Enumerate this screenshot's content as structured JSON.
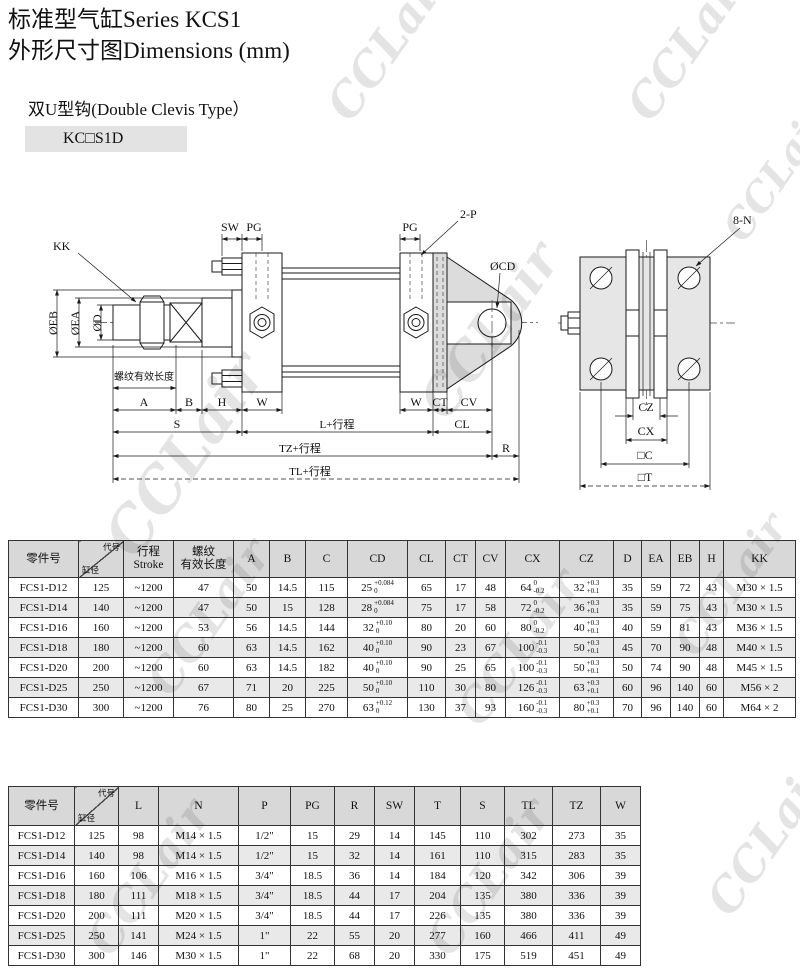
{
  "page": {
    "title_line1": "标准型气缸Series KCS1",
    "title_line2": "外形尺寸图Dimensions (mm)",
    "subtitle": "双U型钩(Double Clevis Type）",
    "model_badge": "KC□S1D",
    "watermark": "CCLair"
  },
  "drawing": {
    "labels": {
      "kk": "KK",
      "eb": "ØEB",
      "ea": "ØEA",
      "d": "ØD",
      "thread": "螺纹有效长度",
      "sw": "SW",
      "pg": "PG",
      "pg2": "PG",
      "two_p": "2-P",
      "cd": "ØCD",
      "a": "A",
      "b": "B",
      "h": "H",
      "w1": "W",
      "w2": "W",
      "ct": "CT",
      "cv": "CV",
      "s": "S",
      "l": "L+行程",
      "cl": "CL",
      "tz": "TZ+行程",
      "r": "R",
      "tl": "TL+行程",
      "n8": "8-N",
      "cz": "CZ",
      "cx": "CX",
      "c": "□C",
      "t": "□T"
    }
  },
  "table1": {
    "headers": [
      {
        "type": "plain",
        "text": "零件号"
      },
      {
        "type": "diag",
        "top": "代号",
        "bottom": "缸径"
      },
      {
        "type": "lines",
        "lines": [
          "行程",
          "Stroke"
        ]
      },
      {
        "type": "lines",
        "lines": [
          "螺纹",
          "有效长度"
        ]
      },
      {
        "type": "plain",
        "text": "A"
      },
      {
        "type": "plain",
        "text": "B"
      },
      {
        "type": "plain",
        "text": "C"
      },
      {
        "type": "plain",
        "text": "CD"
      },
      {
        "type": "plain",
        "text": "CL"
      },
      {
        "type": "plain",
        "text": "CT"
      },
      {
        "type": "plain",
        "text": "CV"
      },
      {
        "type": "plain",
        "text": "CX"
      },
      {
        "type": "plain",
        "text": "CZ"
      },
      {
        "type": "plain",
        "text": "D"
      },
      {
        "type": "plain",
        "text": "EA"
      },
      {
        "type": "plain",
        "text": "EB"
      },
      {
        "type": "plain",
        "text": "H"
      },
      {
        "type": "plain",
        "text": "KK"
      }
    ],
    "rows": [
      [
        "FCS1-D12",
        "125",
        "~1200",
        "47",
        "50",
        "14.5",
        "115",
        {
          "v": "25",
          "t": "+0.084",
          "b": "0"
        },
        "65",
        "17",
        "48",
        {
          "v": "64",
          "t": "0",
          "b": "-0.2"
        },
        {
          "v": "32",
          "t": "+0.3",
          "b": "+0.1"
        },
        "35",
        "59",
        "72",
        "43",
        "M30 × 1.5"
      ],
      [
        "FCS1-D14",
        "140",
        "~1200",
        "47",
        "50",
        "15",
        "128",
        {
          "v": "28",
          "t": "+0.084",
          "b": "0"
        },
        "75",
        "17",
        "58",
        {
          "v": "72",
          "t": "0",
          "b": "-0.2"
        },
        {
          "v": "36",
          "t": "+0.3",
          "b": "+0.1"
        },
        "35",
        "59",
        "75",
        "43",
        "M30 × 1.5"
      ],
      [
        "FCS1-D16",
        "160",
        "~1200",
        "53",
        "56",
        "14.5",
        "144",
        {
          "v": "32",
          "t": "+0.10",
          "b": "0"
        },
        "80",
        "20",
        "60",
        {
          "v": "80",
          "t": "0",
          "b": "-0.2"
        },
        {
          "v": "40",
          "t": "+0.3",
          "b": "+0.1"
        },
        "40",
        "59",
        "81",
        "43",
        "M36 × 1.5"
      ],
      [
        "FCS1-D18",
        "180",
        "~1200",
        "60",
        "63",
        "14.5",
        "162",
        {
          "v": "40",
          "t": "+0.10",
          "b": "0"
        },
        "90",
        "23",
        "67",
        {
          "v": "100",
          "t": "-0.1",
          "b": "-0.3"
        },
        {
          "v": "50",
          "t": "+0.3",
          "b": "+0.1"
        },
        "45",
        "70",
        "90",
        "48",
        "M40 × 1.5"
      ],
      [
        "FCS1-D20",
        "200",
        "~1200",
        "60",
        "63",
        "14.5",
        "182",
        {
          "v": "40",
          "t": "+0.10",
          "b": "0"
        },
        "90",
        "25",
        "65",
        {
          "v": "100",
          "t": "-0.1",
          "b": "-0.3"
        },
        {
          "v": "50",
          "t": "+0.3",
          "b": "+0.1"
        },
        "50",
        "74",
        "90",
        "48",
        "M45 × 1.5"
      ],
      [
        "FCS1-D25",
        "250",
        "~1200",
        "67",
        "71",
        "20",
        "225",
        {
          "v": "50",
          "t": "+0.10",
          "b": "0"
        },
        "110",
        "30",
        "80",
        {
          "v": "126",
          "t": "-0.1",
          "b": "-0.3"
        },
        {
          "v": "63",
          "t": "+0.3",
          "b": "+0.1"
        },
        "60",
        "96",
        "140",
        "60",
        "M56 × 2"
      ],
      [
        "FCS1-D30",
        "300",
        "~1200",
        "76",
        "80",
        "25",
        "270",
        {
          "v": "63",
          "t": "+0.12",
          "b": "0"
        },
        "130",
        "37",
        "93",
        {
          "v": "160",
          "t": "-0.1",
          "b": "-0.3"
        },
        {
          "v": "80",
          "t": "+0.3",
          "b": "+0.1"
        },
        "70",
        "96",
        "140",
        "60",
        "M64 × 2"
      ]
    ]
  },
  "table2": {
    "headers": [
      {
        "type": "plain",
        "text": "零件号"
      },
      {
        "type": "diag",
        "top": "代号",
        "bottom": "缸径"
      },
      {
        "type": "plain",
        "text": "L"
      },
      {
        "type": "plain",
        "text": "N"
      },
      {
        "type": "plain",
        "text": "P"
      },
      {
        "type": "plain",
        "text": "PG"
      },
      {
        "type": "plain",
        "text": "R"
      },
      {
        "type": "plain",
        "text": "SW"
      },
      {
        "type": "plain",
        "text": "T"
      },
      {
        "type": "plain",
        "text": "S"
      },
      {
        "type": "plain",
        "text": "TL"
      },
      {
        "type": "plain",
        "text": "TZ"
      },
      {
        "type": "plain",
        "text": "W"
      }
    ],
    "rows": [
      [
        "FCS1-D12",
        "125",
        "98",
        "M14 × 1.5",
        "1/2\"",
        "15",
        "29",
        "14",
        "145",
        "110",
        "302",
        "273",
        "35"
      ],
      [
        "FCS1-D14",
        "140",
        "98",
        "M14 × 1.5",
        "1/2\"",
        "15",
        "32",
        "14",
        "161",
        "110",
        "315",
        "283",
        "35"
      ],
      [
        "FCS1-D16",
        "160",
        "106",
        "M16 × 1.5",
        "3/4\"",
        "18.5",
        "36",
        "14",
        "184",
        "120",
        "342",
        "306",
        "39"
      ],
      [
        "FCS1-D18",
        "180",
        "111",
        "M18 × 1.5",
        "3/4\"",
        "18.5",
        "44",
        "17",
        "204",
        "135",
        "380",
        "336",
        "39"
      ],
      [
        "FCS1-D20",
        "200",
        "111",
        "M20 × 1.5",
        "3/4\"",
        "18.5",
        "44",
        "17",
        "226",
        "135",
        "380",
        "336",
        "39"
      ],
      [
        "FCS1-D25",
        "250",
        "141",
        "M24 × 1.5",
        "1\"",
        "22",
        "55",
        "20",
        "277",
        "160",
        "466",
        "411",
        "49"
      ],
      [
        "FCS1-D30",
        "300",
        "146",
        "M30 × 1.5",
        "1\"",
        "22",
        "68",
        "20",
        "330",
        "175",
        "519",
        "451",
        "49"
      ]
    ]
  }
}
